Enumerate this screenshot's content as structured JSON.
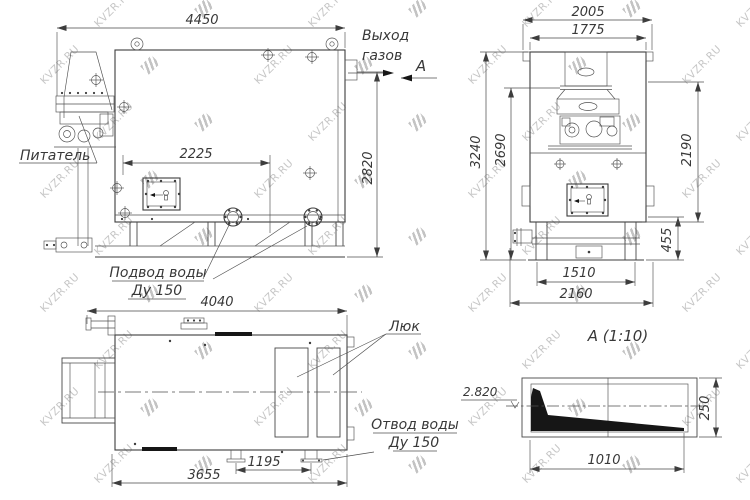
{
  "watermark": {
    "text": "KVZR.RU"
  },
  "drawing": {
    "line_color": "#3d3d3d",
    "watermark_color": "#c7c7c7"
  },
  "labels": {
    "gas_outlet_line1": "Выход",
    "gas_outlet_line2": "газов",
    "section_arrow": "А",
    "feeder": "Питатель",
    "water_inlet_line1": "Подвод воды",
    "water_inlet_line2": "Ду 150",
    "hatch": "Люк",
    "water_outlet_line1": "Отвод воды",
    "water_outlet_line2": "Ду 150",
    "detail_title": "А  (1:10)"
  },
  "dimensions": {
    "side_view": {
      "overall_length": "4450",
      "hatch_offset": "2225",
      "overall_height": "2820"
    },
    "front_view": {
      "overall_width": "2005",
      "body_width": "1775",
      "overall_height": "3240",
      "mid_height": "2690",
      "right_height": "2190",
      "base_height": "455",
      "base_inner_width": "1510",
      "base_width": "2160"
    },
    "top_view": {
      "overall_length": "4040",
      "frame_length": "3655",
      "outlet_offset": "1195"
    },
    "detail_a": {
      "elevation": "2.820",
      "height": "250",
      "length": "1010"
    }
  }
}
